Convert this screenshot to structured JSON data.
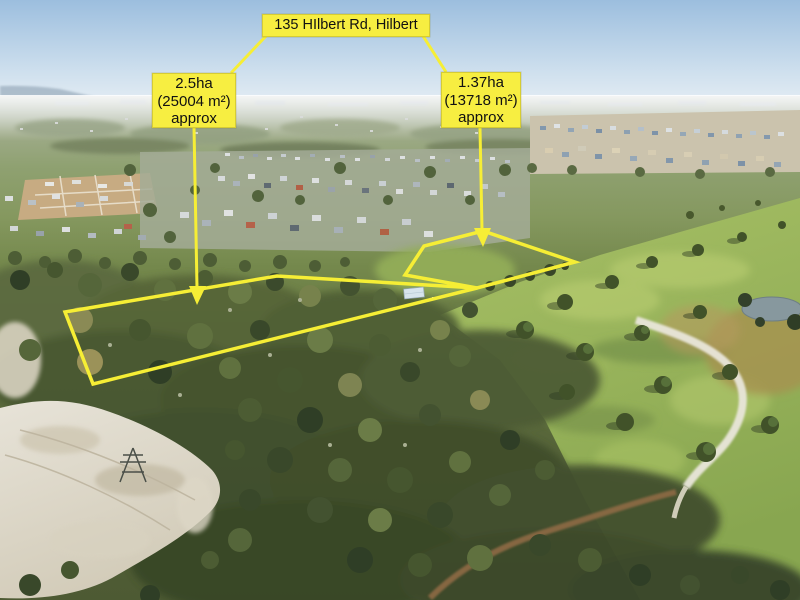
{
  "annotation": {
    "address_label": "135 HIlbert Rd, Hilbert",
    "parcels": [
      {
        "name": "large-parcel",
        "area_ha": "2.5ha",
        "area_m2": "(25004 m²)",
        "approx": "approx",
        "points": "65,312 277,276 477,288 93,384"
      },
      {
        "name": "small-parcel",
        "area_ha": "1.37ha",
        "area_m2": "(13718 m²)",
        "approx": "approx",
        "points": "405,275 424,246 483,231 575,262 477,288"
      }
    ],
    "highlight_color": "#f6ee35",
    "label_bg_color": "#f7ee41",
    "label_text_color": "#111111"
  }
}
